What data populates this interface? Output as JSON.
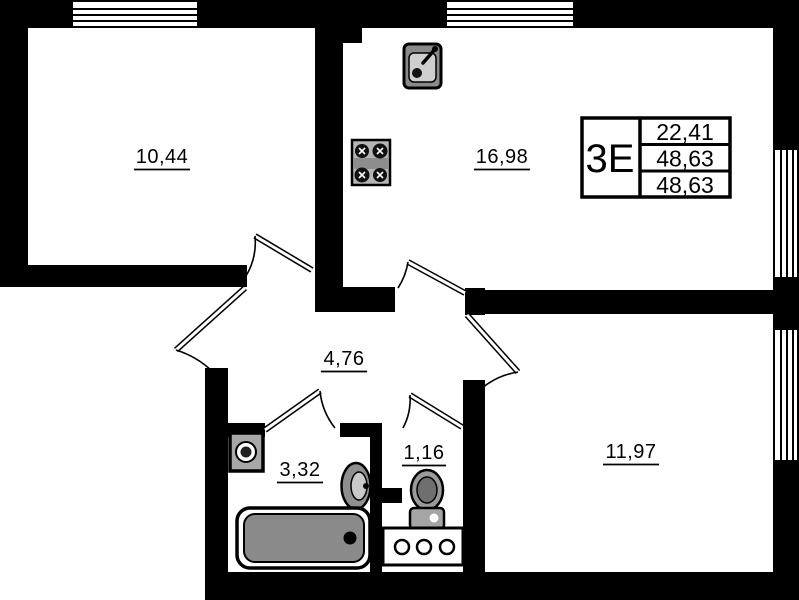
{
  "unit_stamp": {
    "type": "3E",
    "values": [
      "22,41",
      "48,63",
      "48,63"
    ]
  },
  "rooms": {
    "living": "10,44",
    "kitchen_living": "16,98",
    "hall": "4,76",
    "bathroom": "3,32",
    "wc": "1,16",
    "bedroom": "11,97"
  }
}
